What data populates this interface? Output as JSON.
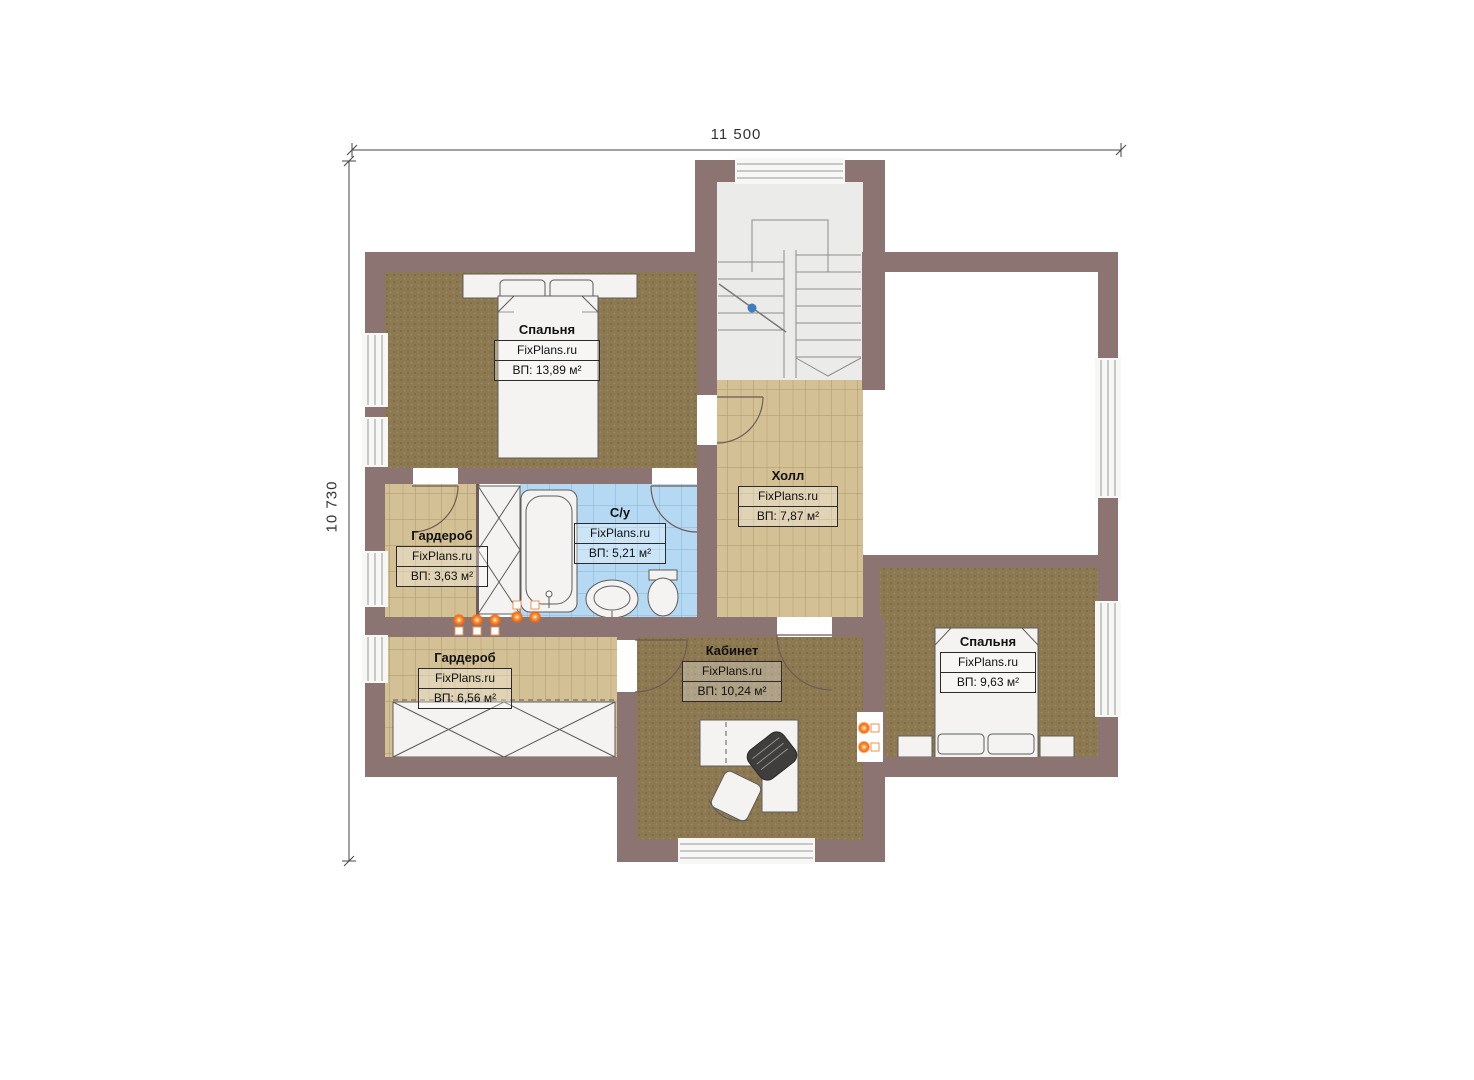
{
  "page": {
    "type": "floor-plan",
    "brand": "FixPlans.ru",
    "floor": "second-floor-plan"
  },
  "dimensions": {
    "top_width": "11 500",
    "left_height": "10 730"
  },
  "rooms": [
    {
      "id": "bedroom-1",
      "name": "Спальня",
      "brand": "FixPlans.ru",
      "area": "ВП: 13,89 м²"
    },
    {
      "id": "hall",
      "name": "Холл",
      "brand": "FixPlans.ru",
      "area": "ВП: 7,87 м²"
    },
    {
      "id": "wardrobe-small",
      "name": "Гардероб",
      "brand": "FixPlans.ru",
      "area": "ВП: 3,63 м²"
    },
    {
      "id": "bathroom",
      "name": "С/у",
      "brand": "FixPlans.ru",
      "area": "ВП: 5,21 м²"
    },
    {
      "id": "wardrobe-big",
      "name": "Гардероб",
      "brand": "FixPlans.ru",
      "area": "ВП: 6,56 м²"
    },
    {
      "id": "office",
      "name": "Кабинет",
      "brand": "FixPlans.ru",
      "area": "ВП: 10,24 м²"
    },
    {
      "id": "bedroom-2",
      "name": "Спальня",
      "brand": "FixPlans.ru",
      "area": "ВП: 9,63 м²"
    }
  ],
  "colors": {
    "wall": "#8b7472",
    "carpet_brown": "#8d7951",
    "tile_tan": "#d4c095",
    "tile_blue": "#b5d9f2",
    "stair_floor": "#ebebea",
    "furniture_white": "#f4f3f1",
    "radiator_orange": "#f26a13",
    "stair_marker_blue": "#3d7dc1",
    "dimension_line": "#333333"
  }
}
